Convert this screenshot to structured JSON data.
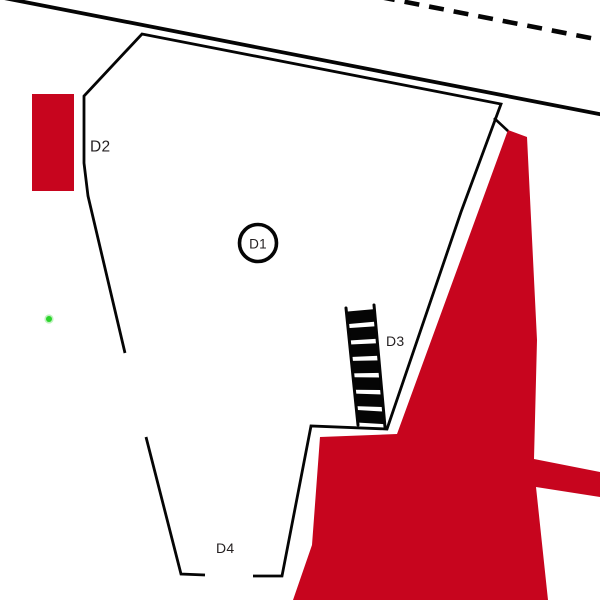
{
  "plan": {
    "feature_labels": {
      "d1": "D1",
      "d2": "D2",
      "d3": "D3",
      "d4": "D4"
    },
    "colors": {
      "red_area": "#C7051E",
      "line": "#050505",
      "green_point": "#2BD42B",
      "label_text": "#231F20",
      "background": "#FFFFFF"
    }
  }
}
